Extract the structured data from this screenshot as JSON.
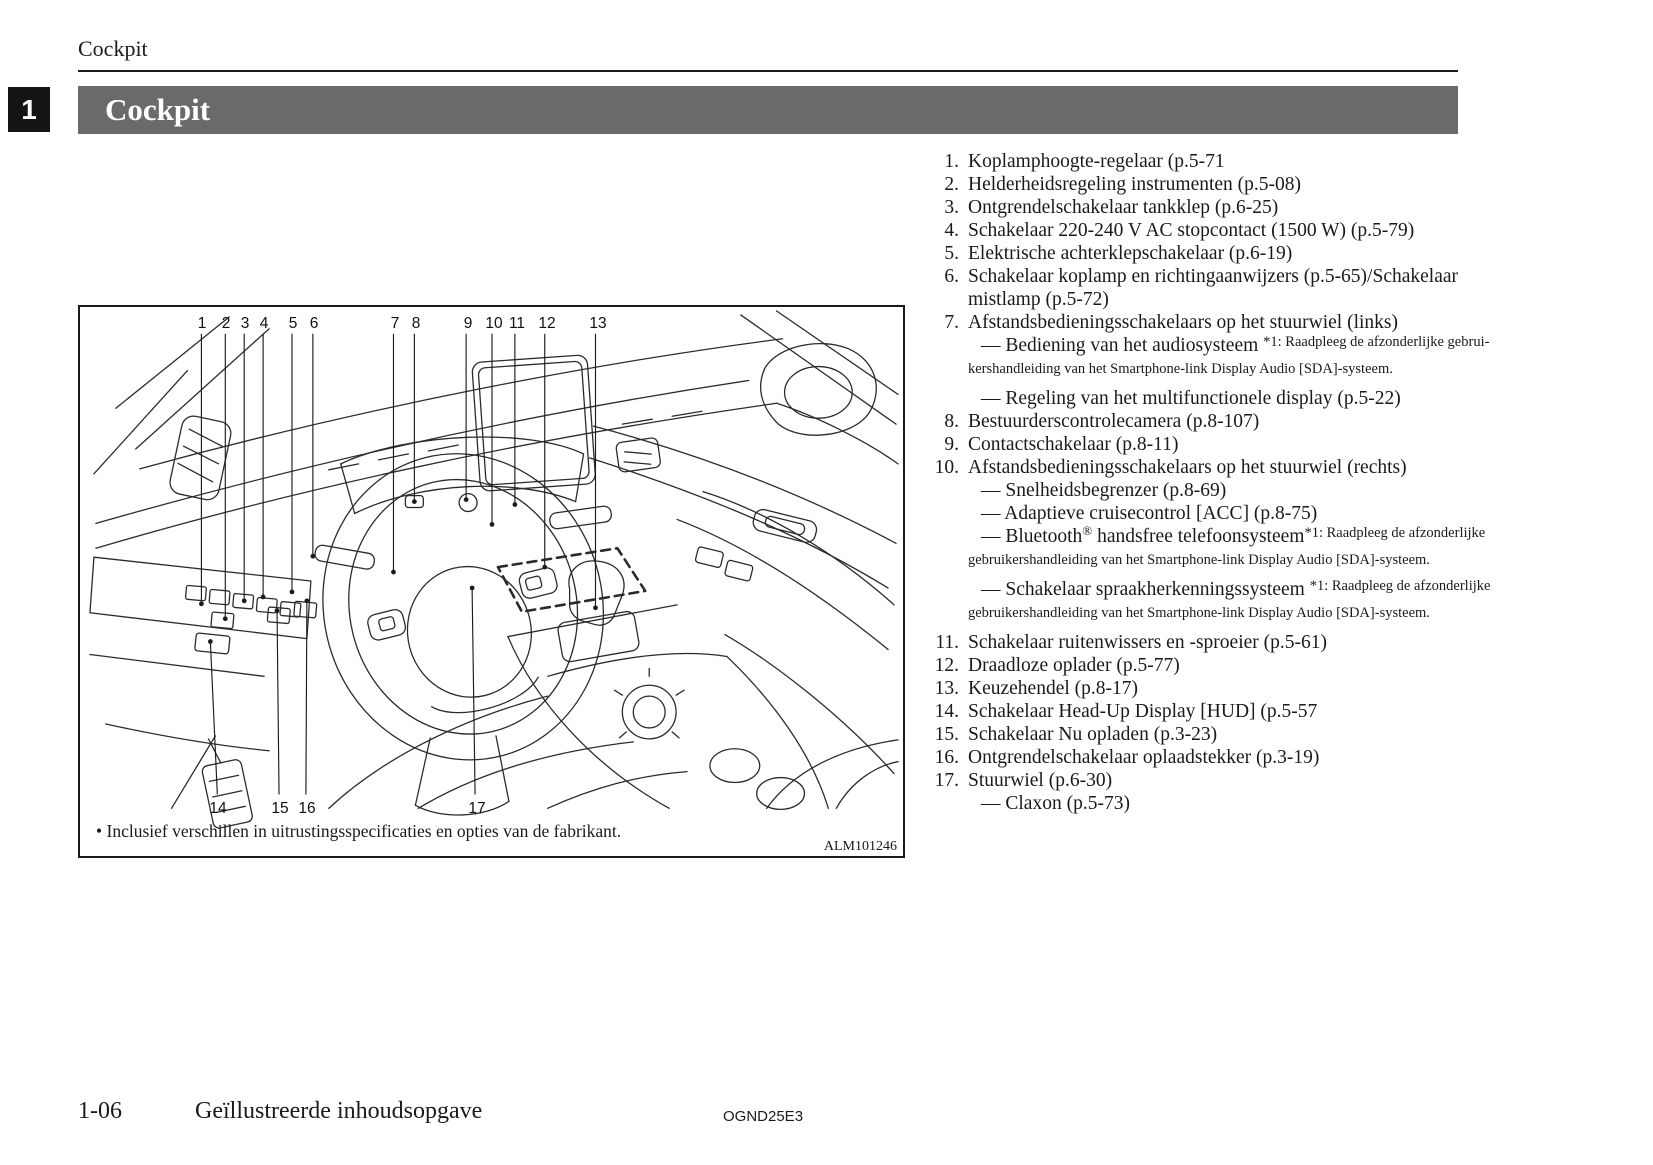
{
  "page": {
    "header_small": "Cockpit",
    "chapter_number": "1",
    "banner_title": "Cockpit",
    "footer": {
      "page_number": "1-06",
      "section_title": "Geïllustreerde inhoudsopgave",
      "doc_code": "OGND25E3"
    }
  },
  "colors": {
    "banner_bg": "#6a6a6a",
    "tab_bg": "#141414",
    "text": "#1a1a1a"
  },
  "diagram": {
    "caption": "• Inclusief verschillen in uitrustingsspecificaties en opties van de fabrikant.",
    "figure_code": "ALM101246",
    "callouts": [
      {
        "n": "1",
        "pos": "top",
        "lx": 122,
        "ly": 17,
        "tx": 122,
        "ty": 299
      },
      {
        "n": "2",
        "pos": "top",
        "lx": 146,
        "ly": 17,
        "tx": 146,
        "ty": 314
      },
      {
        "n": "3",
        "pos": "top",
        "lx": 165,
        "ly": 17,
        "tx": 165,
        "ty": 296
      },
      {
        "n": "4",
        "pos": "top",
        "lx": 184,
        "ly": 17,
        "tx": 184,
        "ty": 292
      },
      {
        "n": "5",
        "pos": "top",
        "lx": 213,
        "ly": 17,
        "tx": 213,
        "ty": 287
      },
      {
        "n": "6",
        "pos": "top",
        "lx": 234,
        "ly": 17,
        "tx": 234,
        "ty": 251
      },
      {
        "n": "7",
        "pos": "top",
        "lx": 315,
        "ly": 17,
        "tx": 315,
        "ty": 267
      },
      {
        "n": "8",
        "pos": "top",
        "lx": 336,
        "ly": 17,
        "tx": 336,
        "ty": 196
      },
      {
        "n": "9",
        "pos": "top",
        "lx": 388,
        "ly": 17,
        "tx": 388,
        "ty": 194
      },
      {
        "n": "10",
        "pos": "top",
        "lx": 414,
        "ly": 17,
        "tx": 414,
        "ty": 219
      },
      {
        "n": "11",
        "pos": "top",
        "lx": 437,
        "ly": 17,
        "tx": 437,
        "ty": 199
      },
      {
        "n": "12",
        "pos": "top",
        "lx": 467,
        "ly": 17,
        "tx": 467,
        "ty": 262
      },
      {
        "n": "13",
        "pos": "top",
        "lx": 518,
        "ly": 17,
        "tx": 518,
        "ty": 303
      },
      {
        "n": "14",
        "pos": "bottom",
        "lx": 138,
        "ly": 502,
        "tx": 131,
        "ty": 337
      },
      {
        "n": "15",
        "pos": "bottom",
        "lx": 200,
        "ly": 502,
        "tx": 198,
        "ty": 306
      },
      {
        "n": "16",
        "pos": "bottom",
        "lx": 227,
        "ly": 502,
        "tx": 228,
        "ty": 296
      },
      {
        "n": "17",
        "pos": "bottom",
        "lx": 397,
        "ly": 502,
        "tx": 394,
        "ty": 283
      }
    ]
  },
  "legend": {
    "items": [
      {
        "num": "1.",
        "lines": [
          "Koplamphoogte-regelaar (p.5-71"
        ]
      },
      {
        "num": "2.",
        "lines": [
          "Helderheidsregeling instrumenten (p.5-08)"
        ]
      },
      {
        "num": "3.",
        "lines": [
          "Ontgrendelschakelaar tankklep (p.6-25)"
        ]
      },
      {
        "num": "4.",
        "lines": [
          "Schakelaar 220-240 V AC stopcontact (1500 W) (p.5-79)"
        ]
      },
      {
        "num": "5.",
        "lines": [
          "Elektrische achterklepschakelaar (p.6-19)"
        ]
      },
      {
        "num": "6.",
        "lines": [
          "Schakelaar koplamp en richtingaanwijzers (p.5-65)/Schakelaar",
          "mistlamp (p.5-72)"
        ]
      },
      {
        "num": "7.",
        "lines": [
          "Afstandsbedieningsschakelaars op het stuurwiel (links)"
        ],
        "subs": [
          {
            "segs": [
              {
                "t": "— Bediening van het audiosysteem "
              },
              {
                "t": "*1: Raadpleeg de afzonderlijke gebrui-",
                "cls": "sup"
              }
            ],
            "cont": "kershandleiding van het Smartphone-link Display Audio [SDA]-systeem.",
            "gap": true
          },
          {
            "segs": [
              {
                "t": "— Regeling van het multifunctionele display (p.5-22)"
              }
            ]
          }
        ]
      },
      {
        "num": "8.",
        "lines": [
          "Bestuurderscontrolecamera (p.8-107)"
        ]
      },
      {
        "num": "9.",
        "lines": [
          "Contactschakelaar (p.8-11)"
        ]
      },
      {
        "num": "10.",
        "lines": [
          "Afstandsbedieningsschakelaars op het stuurwiel (rechts)"
        ],
        "subs": [
          {
            "segs": [
              {
                "t": "— Snelheidsbegrenzer (p.8-69)"
              }
            ]
          },
          {
            "segs": [
              {
                "t": "— Adaptieve cruisecontrol [ACC] (p.8-75)"
              }
            ]
          },
          {
            "segs": [
              {
                "t": "— Bluetooth"
              },
              {
                "t": "®",
                "cls": "reg"
              },
              {
                "t": " handsfree telefoonsysteem"
              },
              {
                "t": "*1: Raadpleeg de afzonderlijke",
                "cls": "sup"
              }
            ],
            "cont": "gebruikershandleiding van het Smartphone-link Display Audio [SDA]-systeem.",
            "gap": true
          },
          {
            "segs": [
              {
                "t": "— Schakelaar spraakherkenningssysteem "
              },
              {
                "t": "*1: Raadpleeg de afzonderlijke",
                "cls": "sup"
              }
            ],
            "cont": "gebruikershandleiding van het Smartphone-link Display Audio [SDA]-systeem.",
            "gap": true
          }
        ]
      },
      {
        "num": "11.",
        "lines": [
          "Schakelaar ruitenwissers en -sproeier (p.5-61)"
        ]
      },
      {
        "num": "12.",
        "lines": [
          "Draadloze oplader (p.5-77)"
        ]
      },
      {
        "num": "13.",
        "lines": [
          "Keuzehendel (p.8-17)"
        ]
      },
      {
        "num": "14.",
        "lines": [
          "Schakelaar Head-Up Display [HUD] (p.5-57"
        ]
      },
      {
        "num": "15.",
        "lines": [
          "Schakelaar Nu opladen (p.3-23)"
        ]
      },
      {
        "num": "16.",
        "lines": [
          "Ontgrendelschakelaar oplaadstekker (p.3-19)"
        ]
      },
      {
        "num": "17.",
        "lines": [
          "Stuurwiel (p.6-30)"
        ],
        "subs": [
          {
            "segs": [
              {
                "t": "— Claxon (p.5-73)"
              }
            ]
          }
        ]
      }
    ]
  }
}
